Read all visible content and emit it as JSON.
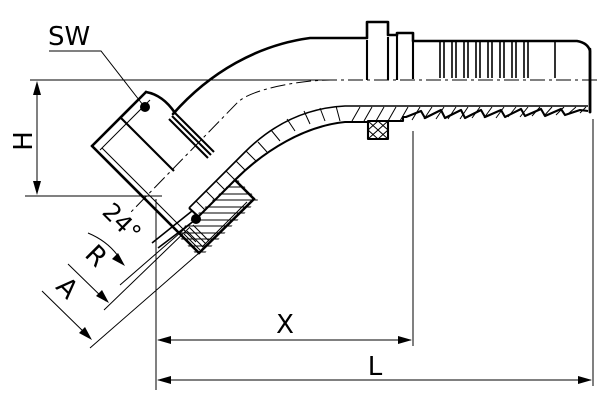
{
  "drawing": {
    "description": "45-degree elbow hose fitting sectional drawing",
    "labels": {
      "wrench_size": "SW",
      "height": "H",
      "cone_angle": "24°",
      "thread": "R",
      "seal_head": "A",
      "cutoff_length": "X",
      "overall_length": "L"
    },
    "colors": {
      "line": "#000000",
      "background": "#ffffff"
    }
  }
}
